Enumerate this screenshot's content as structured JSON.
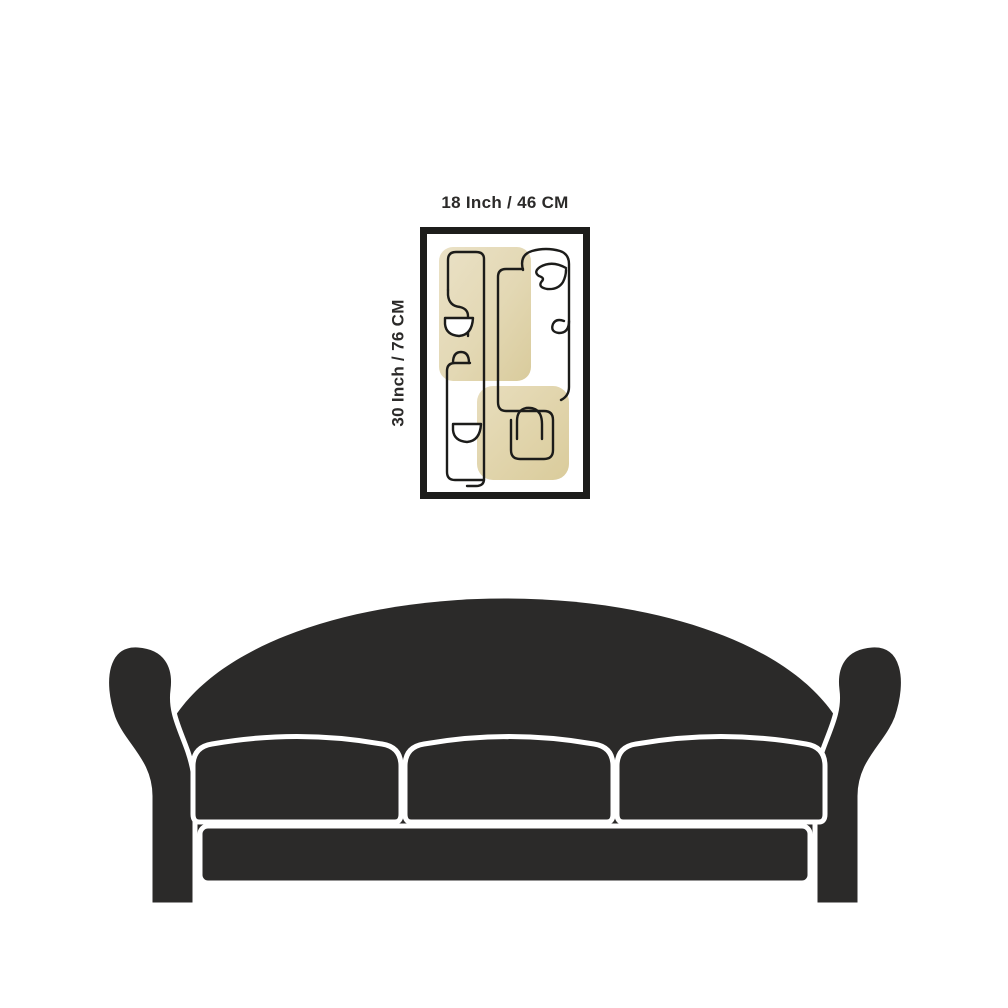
{
  "page": {
    "background_color": "#ffffff",
    "description": "Wall art size guide showing framed abstract print above a sofa silhouette"
  },
  "illustration": {
    "width_dimension_label": "18 Inch / 46 CM",
    "height_dimension_label": "30 Inch / 76 CM"
  },
  "artwork": {
    "frame_color": "#1d1d1b",
    "mat_color": "#ffffff",
    "wash_color_light": "#e9e0c2",
    "wash_color_dark": "#dbcd9f",
    "line_color": "#1c1c1a",
    "style": "abstract one-line face drawing with beige watercolor blocks"
  },
  "sofa": {
    "color": "#2b2a29",
    "outline_color": "#ffffff",
    "cushion_count": 3
  }
}
